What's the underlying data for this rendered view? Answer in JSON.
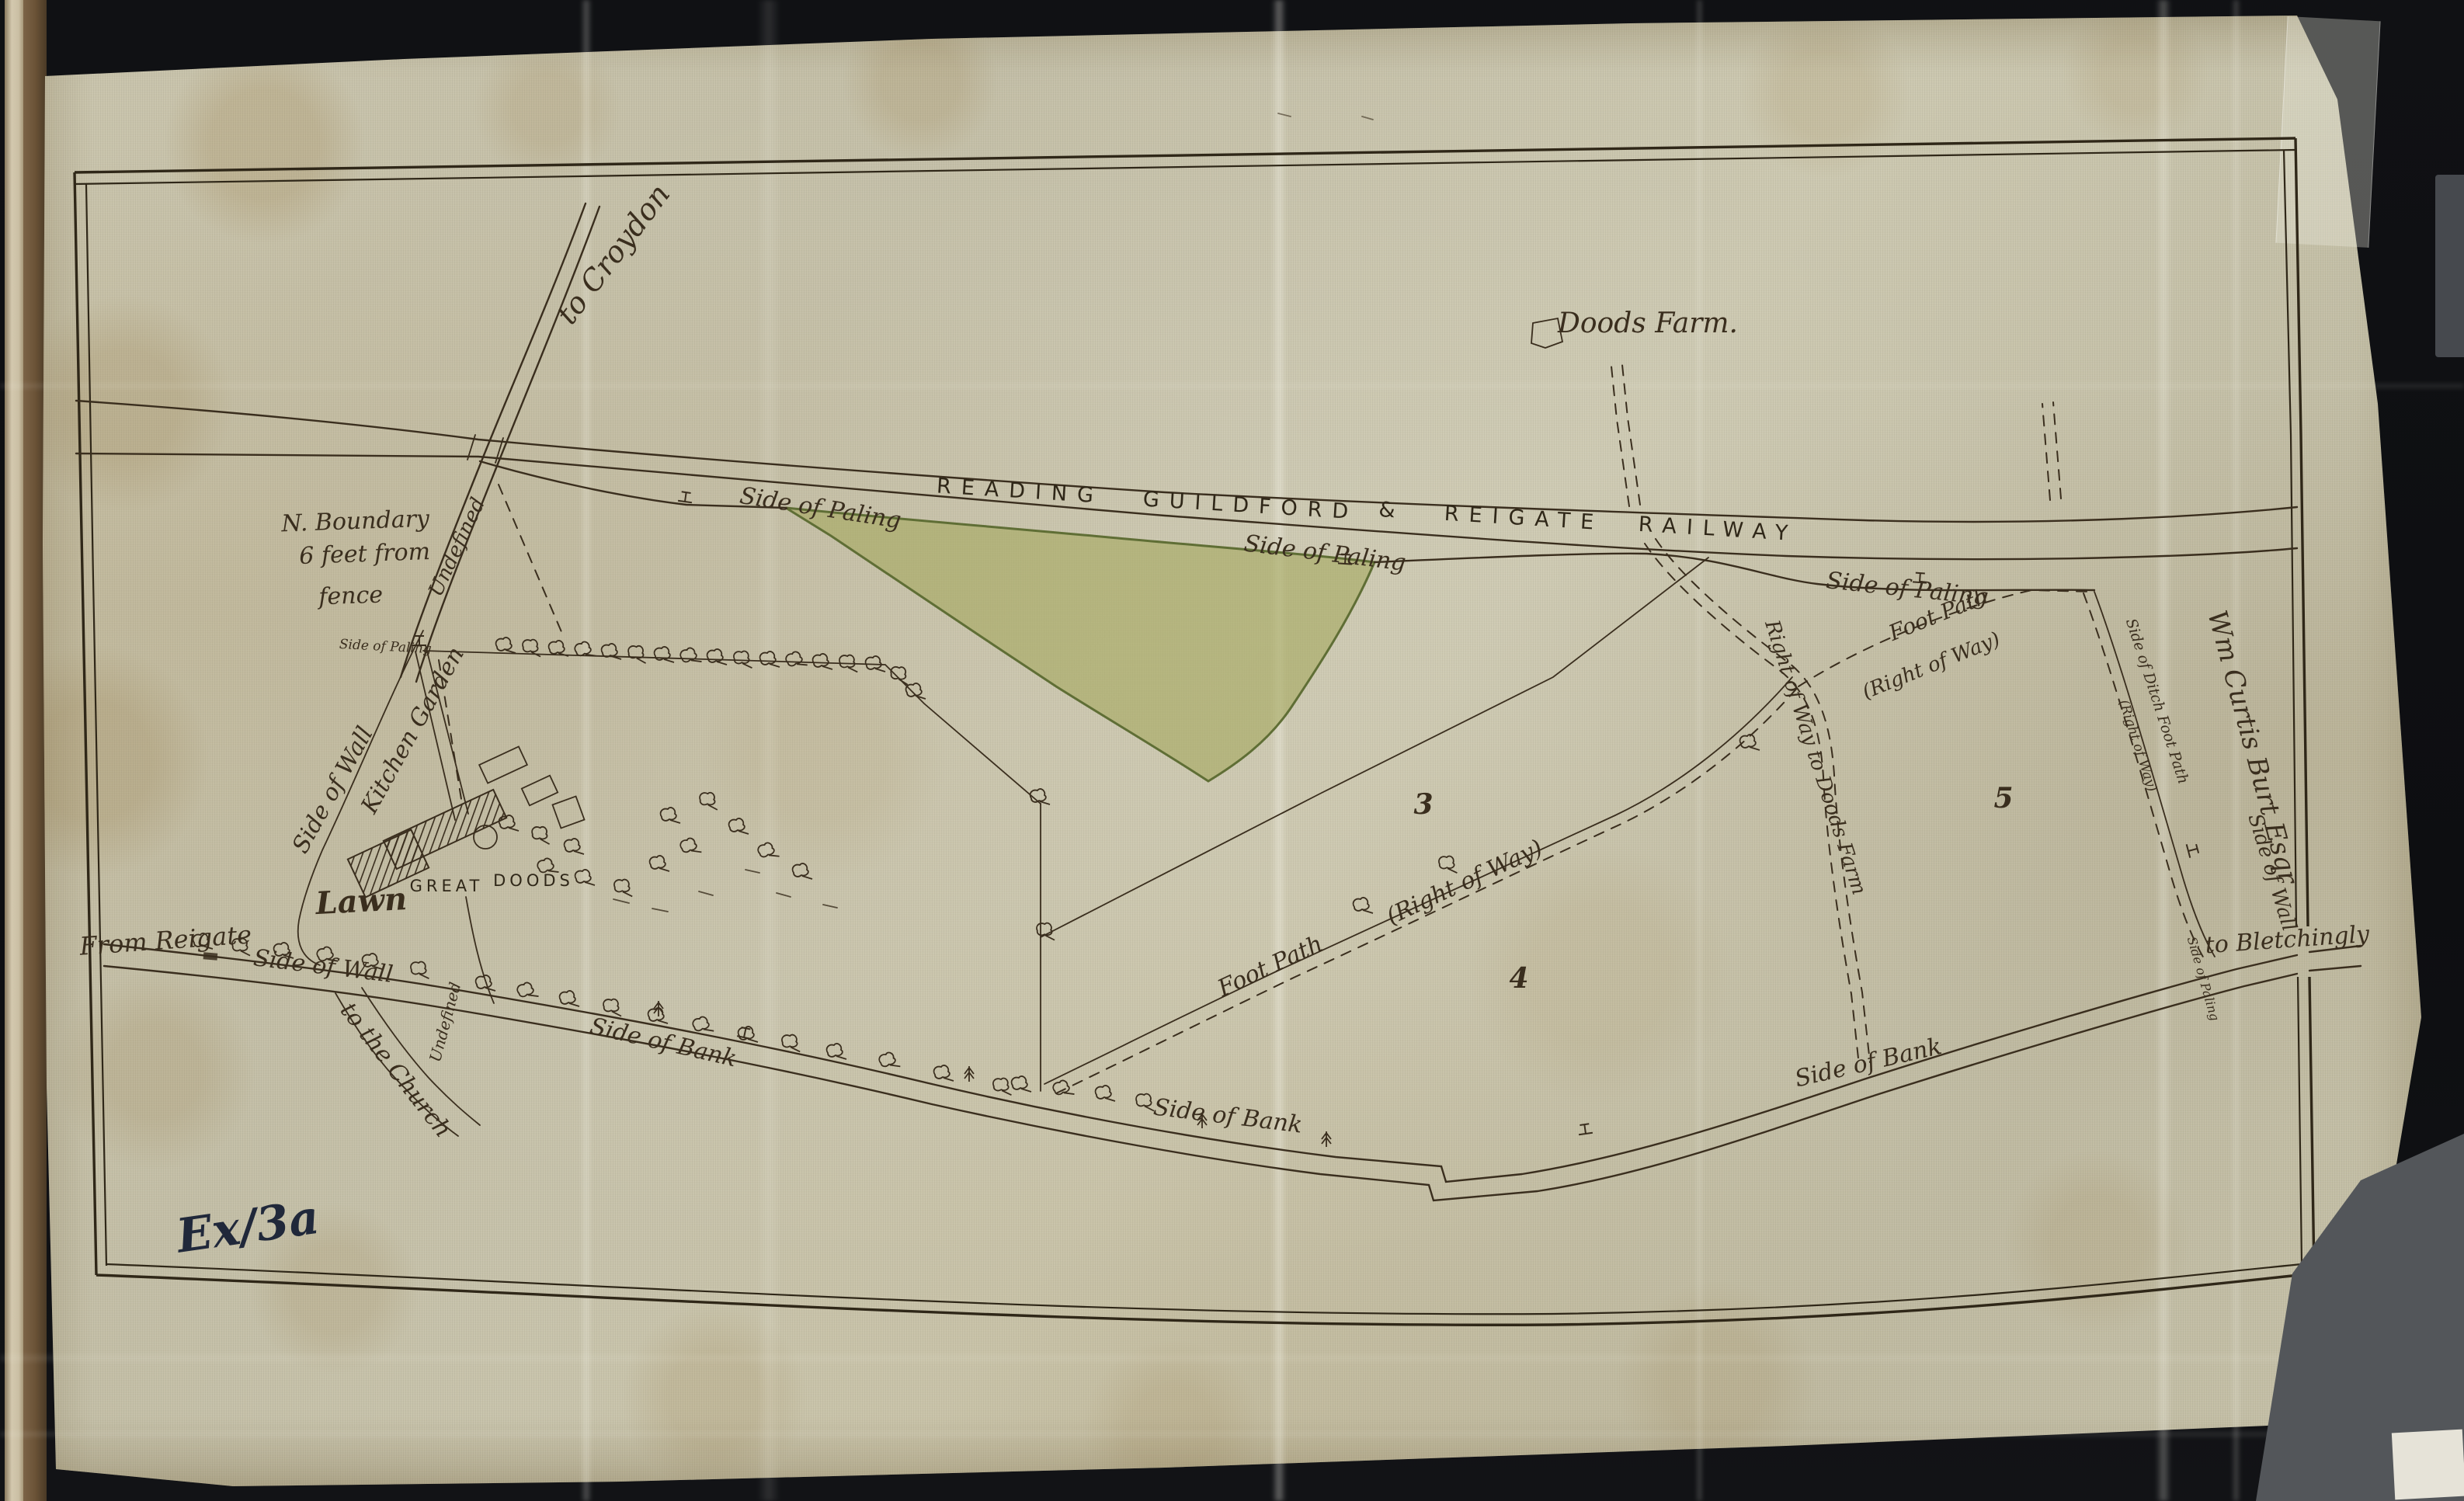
{
  "colors": {
    "ink": "#3a2e1e",
    "ink-dark": "#2f2718",
    "green": "#a3a75c",
    "green-edge": "#5f6e35",
    "exhibit": "#20283a"
  },
  "labels": {
    "to_croydon": "to Croydon",
    "n_boundary_1": "N. Boundary",
    "n_boundary_2": "6 feet from",
    "n_boundary_3": "fence",
    "undefined_1": "Undefined",
    "undefined_2": "Undefined",
    "paling_small_1": "Side of Paling",
    "paling_small_2": "Side of Paling",
    "side_of_paling_1": "Side of Paling",
    "side_of_paling_2": "Side of Paling",
    "side_of_paling_3": "Side of Paling",
    "doods_farm": "Doods Farm.",
    "kitchen_garden": "Kitchen Garden",
    "side_of_wall_w": "Side of Wall",
    "side_of_wall_s": "Side of Wall",
    "side_of_wall_e": "Side of Wall",
    "great": "GREAT",
    "doods": "DOODS",
    "lawn": "Lawn",
    "from_reigate": "From Reigate",
    "to_the_church": "to the Church",
    "side_of_bank_1": "Side of Bank",
    "side_of_bank_2": "Side of Bank",
    "side_of_bank_3": "Side of Bank",
    "foot_path_1a": "Foot Path",
    "foot_path_1b": "(Right of Way)",
    "foot_path_2a": "Foot Path",
    "foot_path_2b": "(Right of Way)",
    "right_of_way_doods": "Right of Way to Doods Farm",
    "side_of_ditch_a": "Side of Ditch  Foot Path",
    "side_of_ditch_b": "(Right of Way)",
    "wm_curtis": "Wm Curtis Burt Esqr",
    "to_bletchingly": "to Bletchingly",
    "exhibit_mark": "Ex/3a"
  },
  "railway": {
    "w1": "READING",
    "w2": "GUILDFORD",
    "w3": "&",
    "w4": "REIGATE",
    "w5": "RAILWAY"
  },
  "field_numbers": {
    "n3": "3",
    "n4": "4",
    "n5": "5"
  }
}
